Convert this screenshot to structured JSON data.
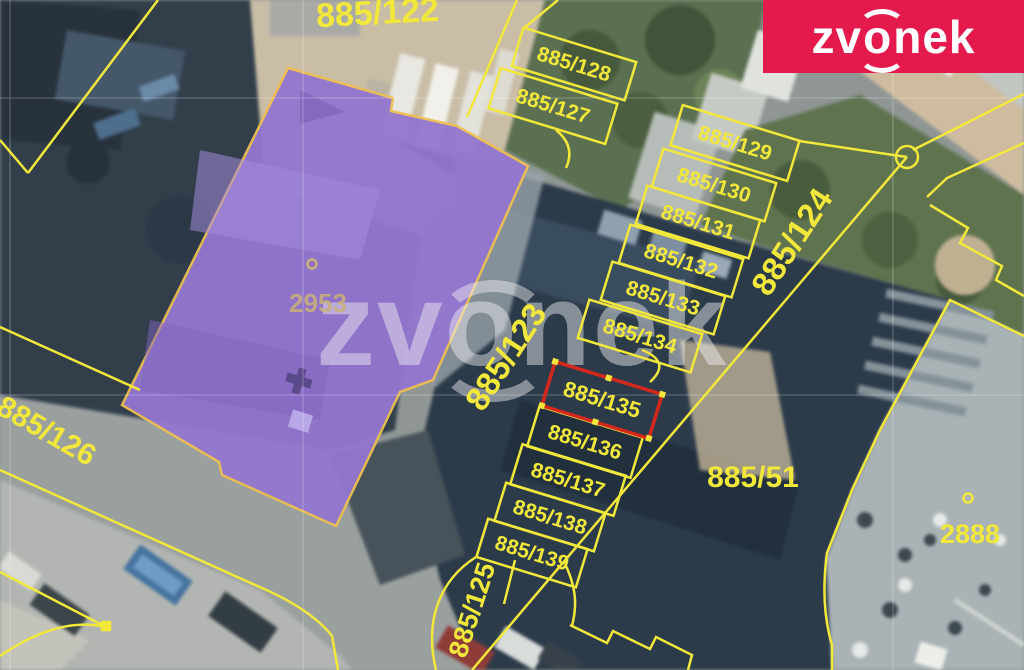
{
  "logo": {
    "brand_pre": "zv",
    "brand_o": "o",
    "brand_post": "nek",
    "bg_color": "#e41a4c"
  },
  "watermark": {
    "pre": "zv",
    "o": "o",
    "post": "nek"
  },
  "map": {
    "colors": {
      "boundary": "#f2e83b",
      "selected": "#d5281c",
      "building_fill": "#9376cf",
      "building_border": "#eebf52",
      "building_number": "#cab178"
    },
    "selected_parcel": "885/135",
    "highlighted_building": "2953",
    "parcels": {
      "p122": "885/122",
      "p123": "885/123",
      "p124": "885/124",
      "p125": "885/125",
      "p126": "885/126",
      "p127": "885/127",
      "p128": "885/128",
      "p129": "885/129",
      "p130": "885/130",
      "p131": "885/131",
      "p132": "885/132",
      "p133": "885/133",
      "p134": "885/134",
      "p135": "885/135",
      "p136": "885/136",
      "p137": "885/137",
      "p138": "885/138",
      "p139": "885/139",
      "p51": "885/51",
      "b2953": "2953",
      "b2888": "2888"
    }
  }
}
